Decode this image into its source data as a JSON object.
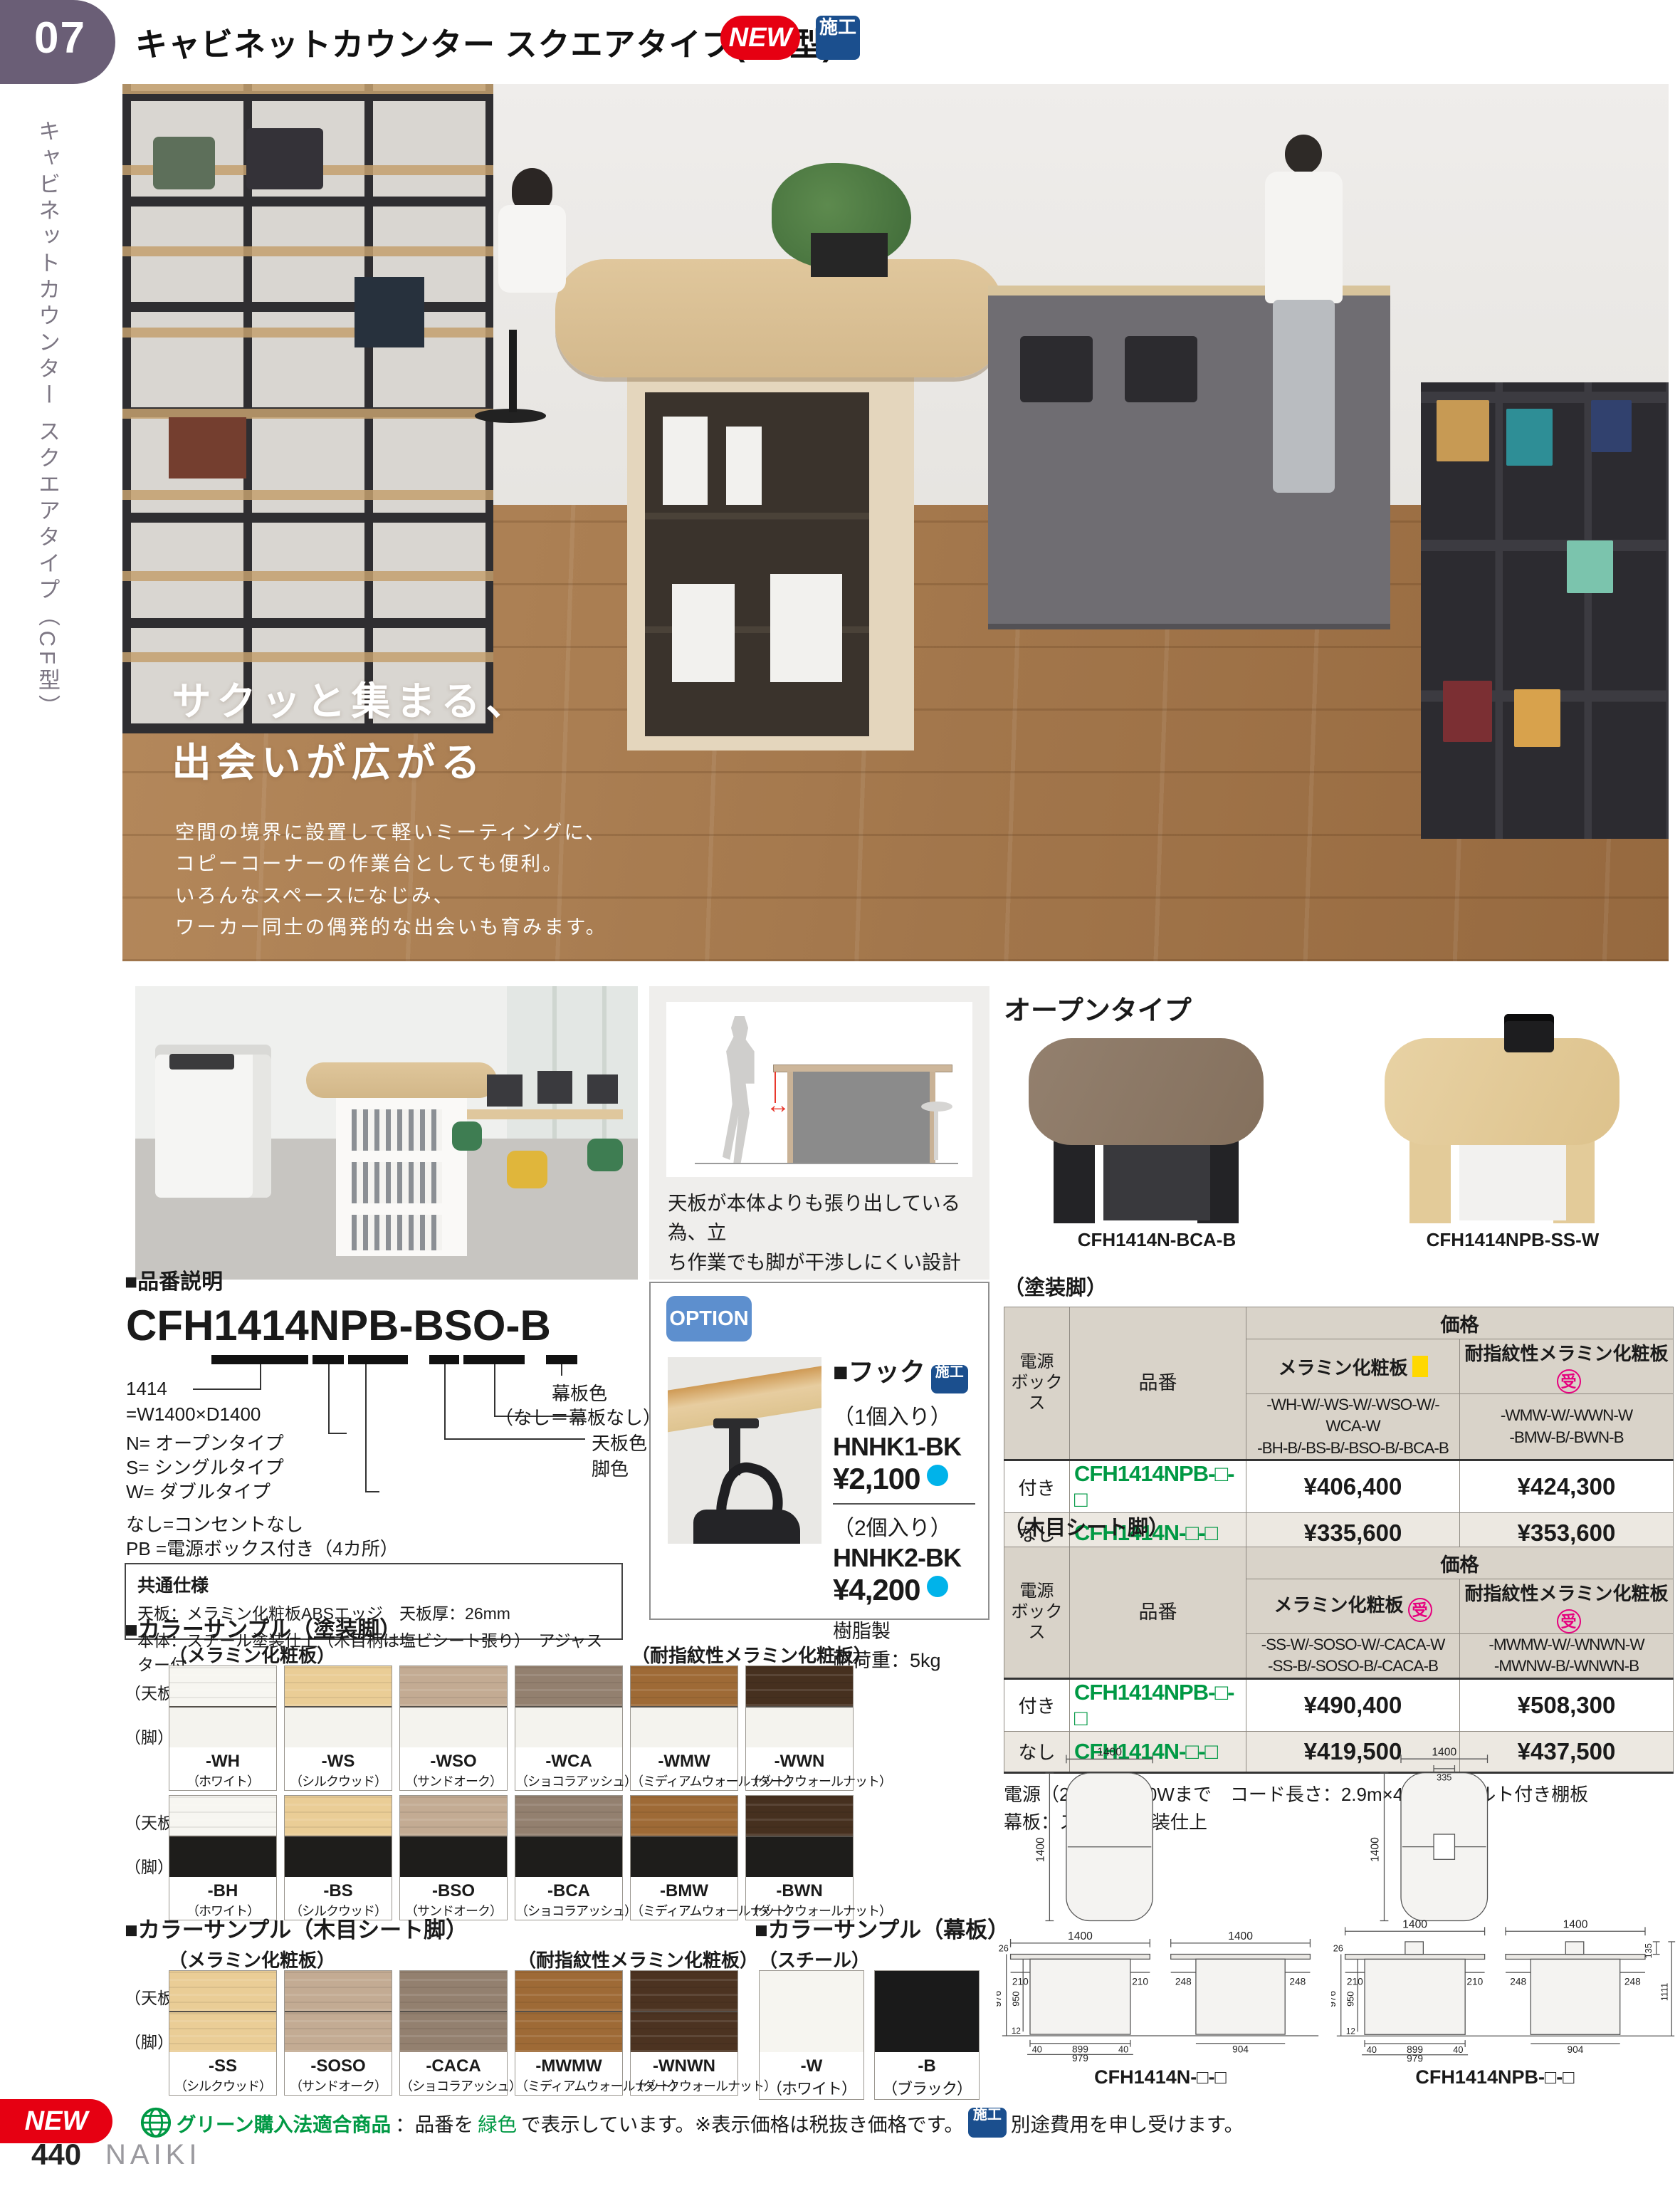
{
  "header": {
    "page_tab": "07",
    "title": "キャビネットカウンター スクエアタイプ(CF型)",
    "new_badge": "NEW",
    "seko_badge": "施工"
  },
  "sidebar": {
    "vertical_title": "キャビネットカウンター スクエアタイプ（CF型）"
  },
  "hero": {
    "tagline1": "サクッと集まる、",
    "tagline2": "出会いが広がる",
    "desc1": "空間の境界に設置して軽いミーティングに、",
    "desc2": "コピーコーナーの作業台としても便利。",
    "desc3": "いろんなスペースになじみ、",
    "desc4": "ワーカー同士の偶発的な出会いも育みます。"
  },
  "feature": {
    "caption1": "天板が本体よりも張り出している為、立",
    "caption2": "ち作業でも脚が干渉しにくい設計となっ",
    "caption3": "ています。"
  },
  "hinban": {
    "heading": "■品番説明",
    "code": "CFH1414NPB-BSO-B",
    "l1": "1414",
    "l2": "=W1400×D1400",
    "l3": "N= オープンタイプ",
    "l4": "S= シングルタイプ",
    "l5": "W= ダブルタイプ",
    "l6": "なし=コンセントなし",
    "l7": "PB =電源ボックス付き（4カ所）",
    "r1": "幕板色",
    "r2": "（なし＝幕板なし）",
    "r3": "天板色",
    "r4": "脚色",
    "spec_title": "共通仕様",
    "spec1": "天板：メラミン化粧板ABSエッジ　天板厚：26mm",
    "spec2": "本体：スチール塗装仕上（木目柄は塩ビシート張り）　アジャスター付"
  },
  "option": {
    "badge": "OPTION",
    "title": "■フック",
    "seko": "施工",
    "qty1": "（1個入り）",
    "code1": "HNHK1-BK",
    "price1": "¥2,100",
    "qty2": "（2個入り）",
    "code2": "HNHK2-BK",
    "price2": "¥4,200",
    "material": "樹脂製",
    "load": "耐荷重：5kg"
  },
  "open_type": {
    "heading": "オープンタイプ",
    "code_left": "CFH1414N-BCA-B",
    "code_right": "CFH1414NPB-SS-W"
  },
  "table_paint": {
    "label": "（塗装脚）",
    "h_power1": "電源",
    "h_power2": "ボックス",
    "h_code": "品番",
    "h_price": "価格",
    "m1": "メラミン化粧板",
    "m2": "耐指紋性メラミン化粧板",
    "m2_mark": "受",
    "c1a": "-WH-W/-WS-W/-WSO-W/-WCA-W",
    "c1b": "-BH-B/-BS-B/-BSO-B/-BCA-B",
    "c2a": "-WMW-W/-WWN-W",
    "c2b": "-BMW-B/-BWN-B",
    "rows": [
      {
        "power": "付き",
        "code": "CFH1414NPB-□-□",
        "p1": "¥406,400",
        "p2": "¥424,300"
      },
      {
        "power": "なし",
        "code": "CFH1414N-□-□",
        "p1": "¥335,600",
        "p2": "¥353,600"
      }
    ],
    "note1": "電源（2口）：1500Wまで　コード長さ：2.9m×4本　フェルト付き棚板",
    "note2": "幕板：スチール塗装仕上"
  },
  "table_sheet": {
    "label": "（木目シート脚）",
    "h_power1": "電源",
    "h_power2": "ボックス",
    "h_code": "品番",
    "h_price": "価格",
    "m1": "メラミン化粧板",
    "m1_mark": "受",
    "m2": "耐指紋性メラミン化粧板",
    "m2_mark": "受",
    "c1a": "-SS-W/-SOSO-W/-CACA-W",
    "c1b": "-SS-B/-SOSO-B/-CACA-B",
    "c2a": "-MWMW-W/-WNWN-W",
    "c2b": "-MWNW-B/-WNWN-B",
    "rows": [
      {
        "power": "付き",
        "code": "CFH1414NPB-□-□",
        "p1": "¥490,400",
        "p2": "¥508,300"
      },
      {
        "power": "なし",
        "code": "CFH1414N-□-□",
        "p1": "¥419,500",
        "p2": "¥437,500"
      }
    ],
    "note1": "電源（2口）：1500Wまで　コード長さ：2.9m×4本　フェルト付き棚板",
    "note2": "幕板：スチール塗装仕上"
  },
  "colors_paint": {
    "heading": "■カラーサンプル（塗装脚）",
    "group1": "（メラミン化粧板）",
    "group2": "（耐指紋性メラミン化粧板）",
    "row_top": "（天板）",
    "row_leg": "（脚）",
    "row1": [
      {
        "code": "-WH",
        "name": "（ホワイト）",
        "top": "#f7f6f1",
        "leg": "#f4f3ee"
      },
      {
        "code": "-WS",
        "name": "（シルクウッド）",
        "top": "#eacd96",
        "leg": "#f4f3ee"
      },
      {
        "code": "-WSO",
        "name": "（サンドオーク）",
        "top": "#c3ab93",
        "leg": "#f4f3ee"
      },
      {
        "code": "-WCA",
        "name": "（ショコラアッシュ）",
        "top": "#93806f",
        "leg": "#f4f3ee"
      },
      {
        "code": "-WMW",
        "name": "（ミディアムウォールナット）",
        "top": "#9e6a36",
        "leg": "#f4f3ee"
      },
      {
        "code": "-WWN",
        "name": "（ダークウォールナット）",
        "top": "#46301f",
        "leg": "#f4f3ee"
      }
    ],
    "row2": [
      {
        "code": "-BH",
        "name": "（ホワイト）",
        "top": "#f7f6f1",
        "leg": "#1e1d1b"
      },
      {
        "code": "-BS",
        "name": "（シルクウッド）",
        "top": "#eacd96",
        "leg": "#1e1d1b"
      },
      {
        "code": "-BSO",
        "name": "（サンドオーク）",
        "top": "#c3ab93",
        "leg": "#1e1d1b"
      },
      {
        "code": "-BCA",
        "name": "（ショコラアッシュ）",
        "top": "#93806f",
        "leg": "#1e1d1b"
      },
      {
        "code": "-BMW",
        "name": "（ミディアムウォールナット）",
        "top": "#9e6a36",
        "leg": "#1e1d1b"
      },
      {
        "code": "-BWN",
        "name": "（ダークウォールナット）",
        "top": "#46301f",
        "leg": "#1e1d1b"
      }
    ]
  },
  "colors_sheet": {
    "heading": "■カラーサンプル（木目シート脚）",
    "group1": "（メラミン化粧板）",
    "group2": "（耐指紋性メラミン化粧板）",
    "row_top": "（天板）",
    "row_leg": "（脚）",
    "items": [
      {
        "code": "-SS",
        "name": "（シルクウッド）",
        "top": "#eacd96",
        "leg": "#eacd96"
      },
      {
        "code": "-SOSO",
        "name": "（サンドオーク）",
        "top": "#c3ab93",
        "leg": "#c3ab93"
      },
      {
        "code": "-CACA",
        "name": "（ショコラアッシュ）",
        "top": "#93806f",
        "leg": "#93806f"
      },
      {
        "code": "-MWMW",
        "name": "（ミディアムウォールナット）",
        "top": "#9e6a36",
        "leg": "#9e6a36"
      },
      {
        "code": "-WNWN",
        "name": "（ダークウォールナット）",
        "top": "#4c3321",
        "leg": "#4c3321"
      }
    ]
  },
  "colors_maku": {
    "heading": "■カラーサンプル（幕板）",
    "group": "（スチール）",
    "items": [
      {
        "code": "-W",
        "name": "（ホワイト）",
        "hex": "#f6f5f0"
      },
      {
        "code": "-B",
        "name": "（ブラック）",
        "hex": "#1a1a1a"
      }
    ]
  },
  "dims": {
    "n": {
      "code": "CFH1414N-□-□",
      "top_w": "1400",
      "top_d": "1400",
      "front_w": "1400",
      "t26": "26",
      "oh210l": "210",
      "oh210r": "210",
      "h976": "976",
      "h950": "950",
      "h12": "12",
      "b40l": "40",
      "b899": "899",
      "b40r": "40",
      "b979": "979",
      "side_w": "1400",
      "oh248l": "248",
      "oh248r": "248",
      "b904": "904"
    },
    "npb": {
      "code": "CFH1414NPB-□-□",
      "top_w": "1400",
      "box_w": "335",
      "top_d": "1400",
      "front_w": "1400",
      "t26": "26",
      "oh210l": "210",
      "oh210r": "210",
      "h976": "976",
      "h950": "950",
      "h12": "12",
      "b40l": "40",
      "b899": "899",
      "b40r": "40",
      "b979": "979",
      "side_w": "1400",
      "oh248l": "248",
      "oh248r": "248",
      "b904": "904",
      "box_h": "135",
      "total_h": "1111"
    }
  },
  "footer": {
    "new": "NEW",
    "green_title": "グリーン購入法適合商品",
    "t1": "：品番を",
    "green_word": "緑色",
    "t2": "で表示しています。※表示価格は税抜き価格です。",
    "seko": "施工",
    "t3": "別途費用を申し受けます。",
    "page": "440",
    "brand": "NAIKI"
  }
}
